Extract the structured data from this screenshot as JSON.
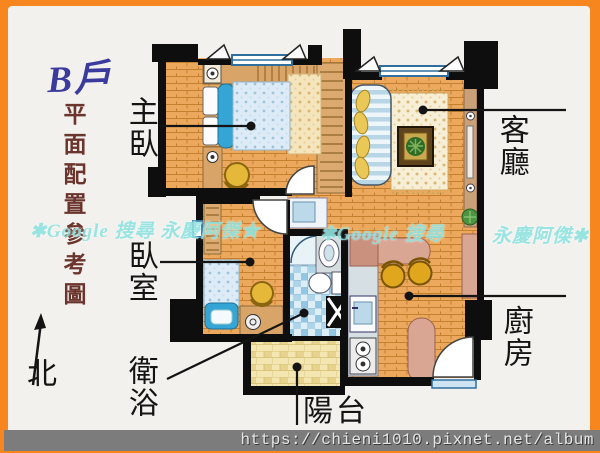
{
  "unit_label": "B戶",
  "plan_title": "平面配置參考圖",
  "room_labels": {
    "master_bedroom": "主臥",
    "living_room": "客廳",
    "bedroom": "臥室",
    "bathroom": "衛浴",
    "kitchen": "廚房",
    "balcony": "陽台"
  },
  "compass": {
    "north": "北"
  },
  "watermark": {
    "segment_left": "✱Google 搜尋 永慶阿傑★",
    "segment_middle": "✱Google 搜尋",
    "segment_right": "永慶阿傑✱"
  },
  "footer": {
    "url": "https://chieni1010.pixnet.net/album"
  },
  "colors": {
    "frame_orange": "#f6861d",
    "background": "#f2f1ee",
    "wall_black": "#0e0e0e",
    "wood_floor": "#eca95e",
    "bathroom_tile": "#aed4ea",
    "balcony_tile": "#f3e6b0",
    "window_blue": "#2e6f9e",
    "unit_label_blue": "#3b3b9e",
    "title_maroon": "#6b342c",
    "watermark_cyan": "#8fe3e0",
    "footer_gray": "#7c7c7c"
  }
}
